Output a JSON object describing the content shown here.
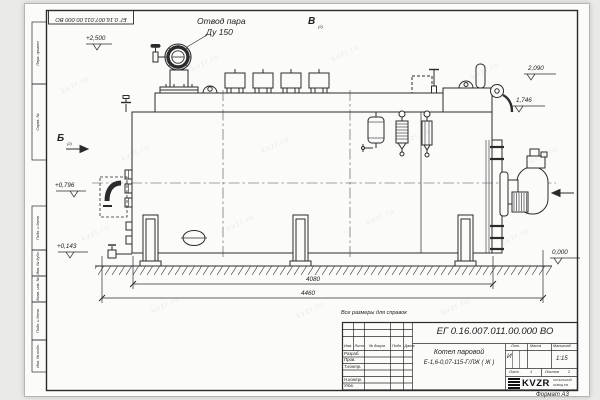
{
  "meta": {
    "format_label": "Формат А3"
  },
  "frame": {
    "top_designation": "ЕГ 0.16.007.011.00.000  ВО",
    "left_labels": [
      "Перв. примен.",
      "Справ. №",
      "Подп. и дата",
      "Инв. № дубл.",
      "Взам. инв. №",
      "Подп. и дата",
      "Инв. № подл."
    ]
  },
  "drawing": {
    "callout": {
      "line1": "Отвод пара",
      "line2": "Ду 150"
    },
    "views": {
      "b": "Б",
      "b_sub": "(2)",
      "v": "В",
      "v_sub": "(2)"
    },
    "elevations": {
      "steam": "+2,500",
      "top": "2,090",
      "platform": "1,746",
      "burner": "+0,796",
      "drain": "+0,143",
      "ground": "0,000"
    },
    "dims": {
      "shell": "4080",
      "total": "4460"
    },
    "watermark": "kvzr.ru"
  },
  "title_block": {
    "note": "Все размеры для справок",
    "designation": "ЕГ 0.16.007.011.00.000  ВО",
    "name_line1": "Котел паровой",
    "name_line2": "Е-1,6-0,07-115-Г/ЛЖ ( Ж )",
    "cols": {
      "izm": "Изм.",
      "list": "Лист",
      "doc": "№ докум.",
      "podp": "Подп.",
      "date": "Дата"
    },
    "rows": [
      "Разраб.",
      "Пров.",
      "Т.контр.",
      "",
      "Н.контр.",
      "Утв."
    ],
    "lit_label": "Лит.",
    "lit_value": "И",
    "mass_label": "Масса",
    "scale_label": "Масштаб",
    "scale_value": "1:15",
    "sheet_label": "Лист",
    "sheet_value": "1",
    "sheets_label": "Листов",
    "sheets_value": "2",
    "brand": {
      "logo": "KVZR",
      "sub1": "КОТЕЛЬНЫЙ",
      "sub2": "ЗАВОД РФ"
    }
  }
}
